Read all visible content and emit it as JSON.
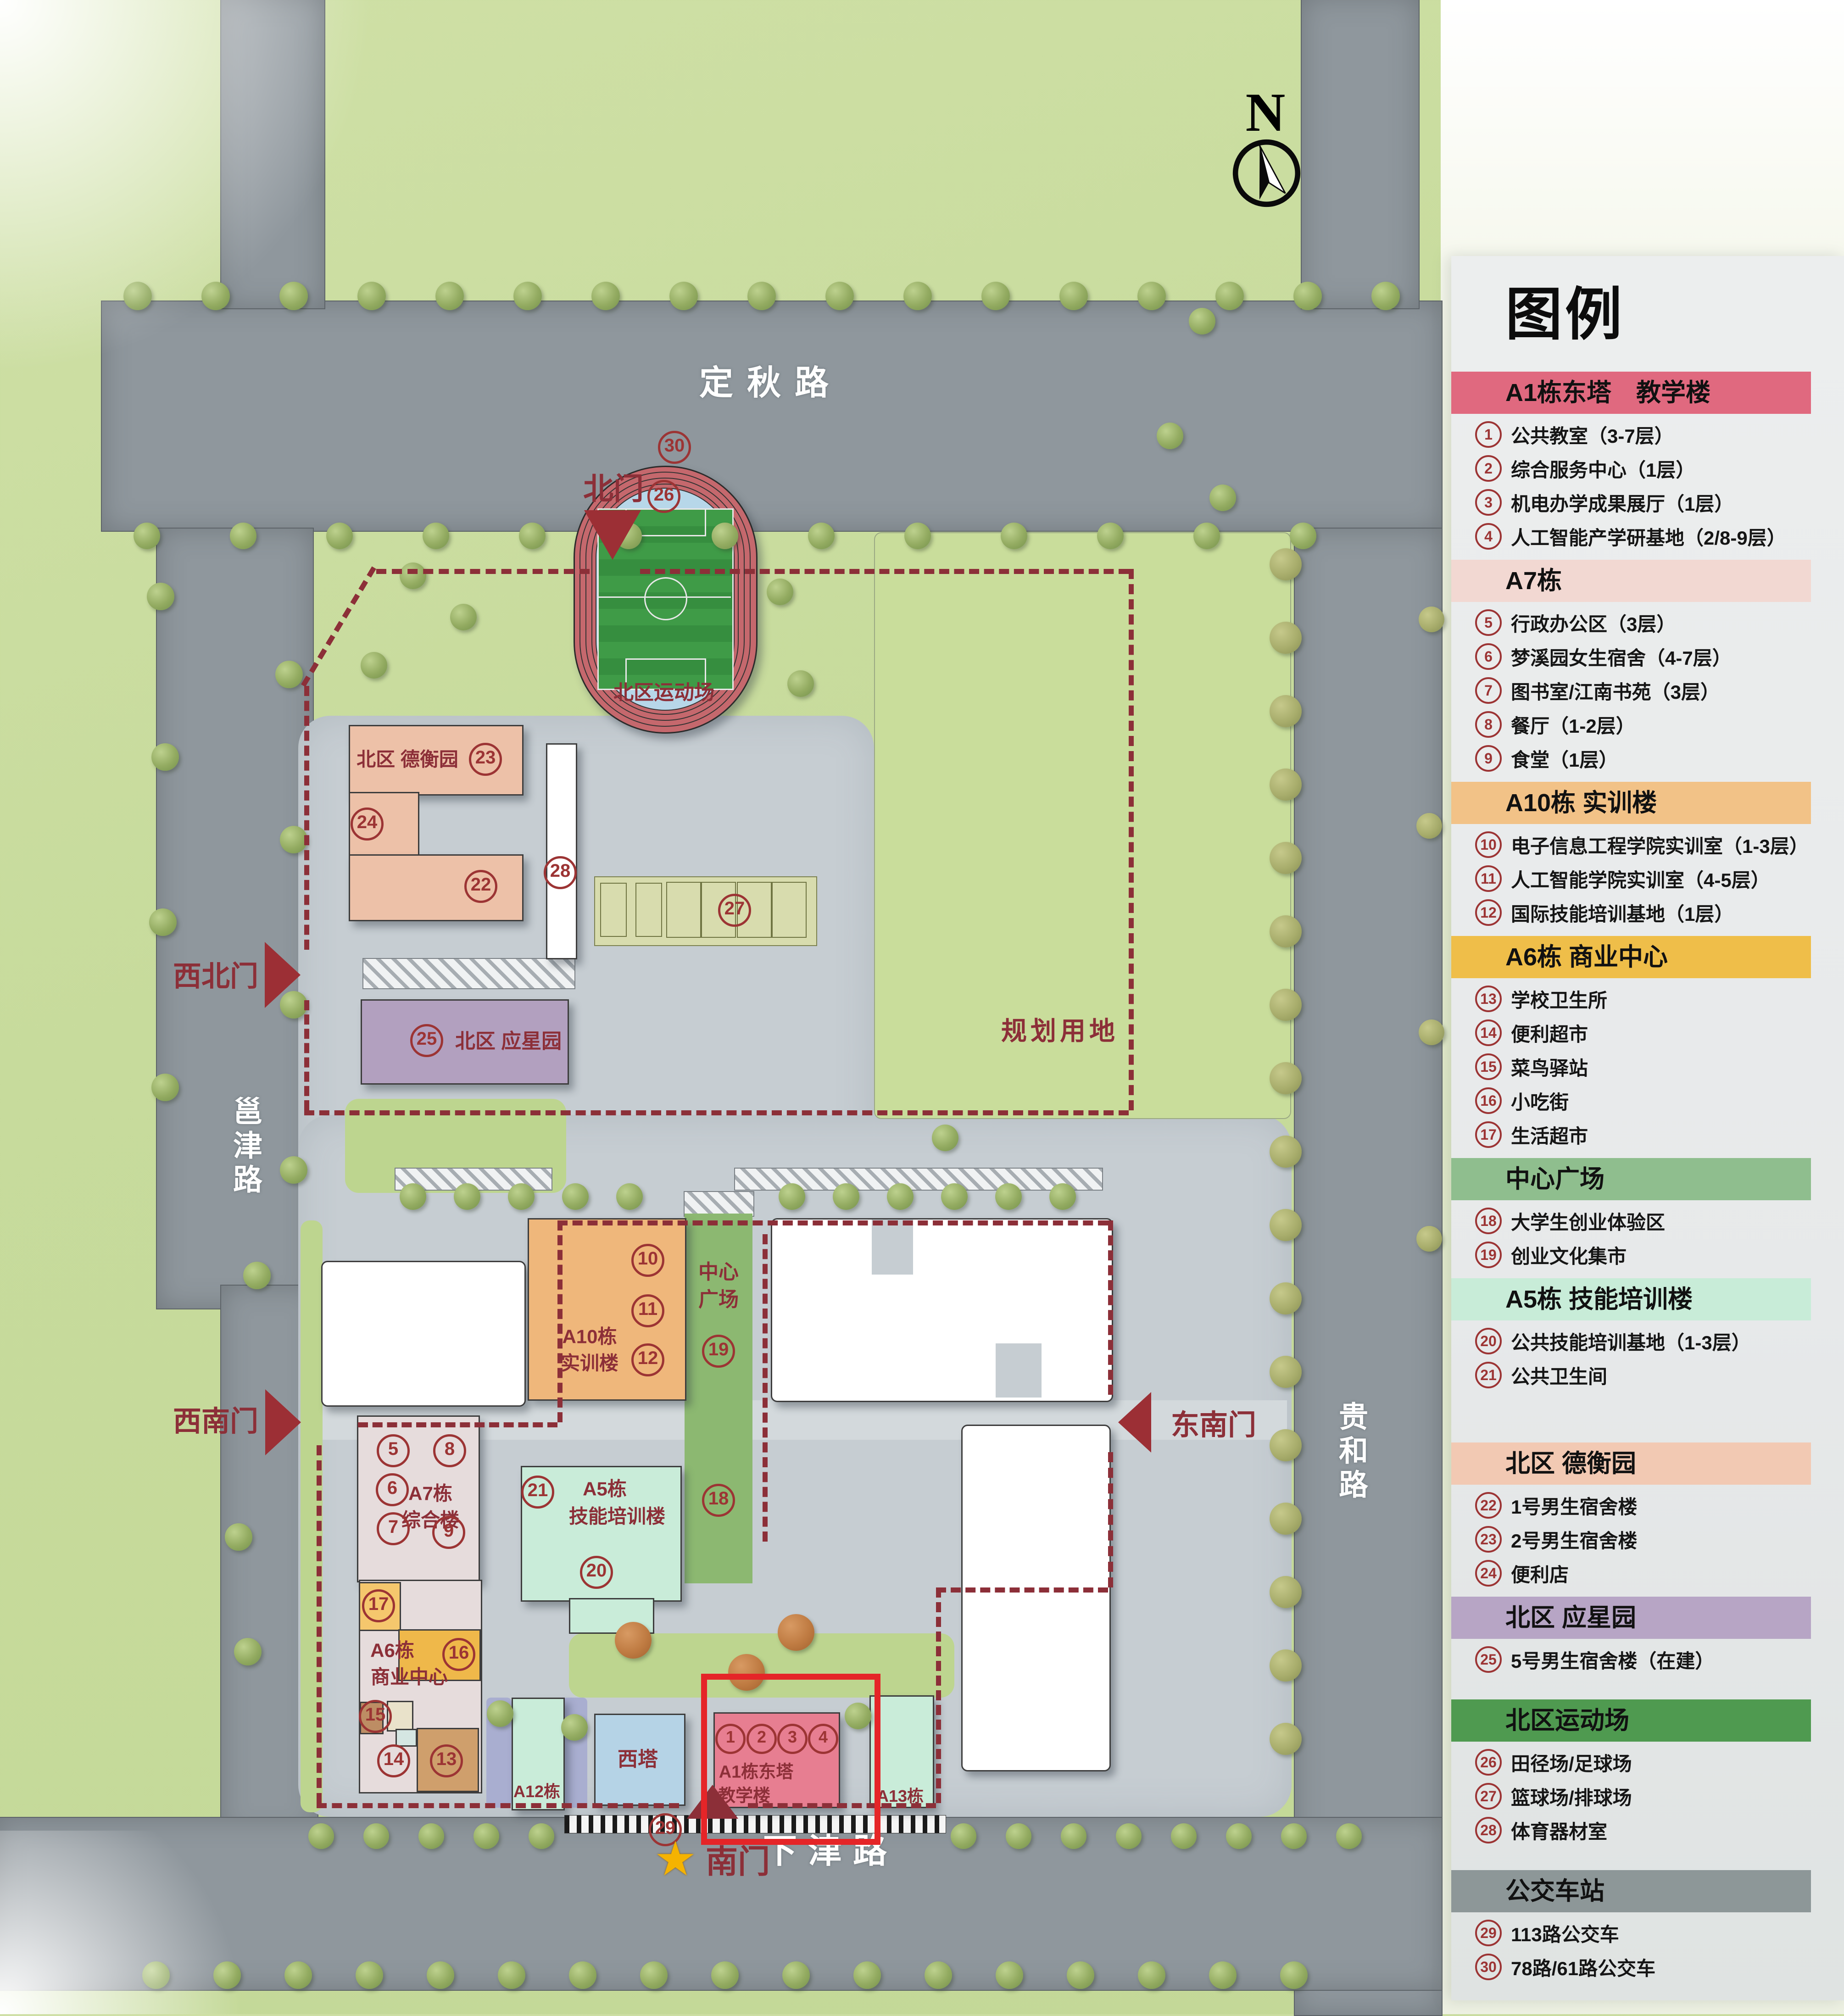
{
  "compass": {
    "north_label": "N"
  },
  "map": {
    "roads": {
      "top": "定秋路",
      "left": "邕津路",
      "right": "贵和路",
      "bottom": "下津路"
    },
    "gates": {
      "north": "北门",
      "northwest": "西北门",
      "southwest": "西南门",
      "southeast": "东南门",
      "south": "南门"
    },
    "areas": {
      "planning": "规划用地",
      "north_sports": "北区运动场",
      "dehengyuan": "北区 德衡园",
      "yingxingyuan": "北区 应星园",
      "plaza_line1": "中心",
      "plaza_line2": "广场"
    },
    "buildings": {
      "a10_line1": "A10栋",
      "a10_line2": "实训楼",
      "a5_line1": "A5栋",
      "a5_line2": "技能培训楼",
      "a7_line1": "A7栋",
      "a7_line2": "综合楼",
      "a6_line1": "A6栋",
      "a6_line2": "商业中心",
      "west_tower": "西塔",
      "a1_line1": "A1栋东塔",
      "a1_line2": "教学楼",
      "a12": "A12栋",
      "a13": "A13栋"
    },
    "markers": [
      "1",
      "2",
      "3",
      "4",
      "5",
      "6",
      "7",
      "8",
      "9",
      "10",
      "11",
      "12",
      "13",
      "14",
      "15",
      "16",
      "17",
      "18",
      "19",
      "20",
      "21",
      "22",
      "23",
      "24",
      "25",
      "26",
      "27",
      "28",
      "29",
      "30"
    ],
    "colors": {
      "boundary_dash": "#8c2f38",
      "marker_red": "#9c3434",
      "a1_pink": "#e77e91",
      "highlight_frame": "#e52528",
      "track_red": "#c5686d",
      "infield_blue": "#b7d7e9",
      "pitch_green": "#3f9b47",
      "dehengyuan_salmon": "#edc1a8",
      "yingxingyuan_purple": "#b2a0bf",
      "a10_orange": "#efb77b",
      "plaza_green": "#8cb871",
      "mint_green": "#c9ecd9",
      "west_tower_blue": "#b5d3e6",
      "star_gold": "#f5b301"
    },
    "south_gate_star": "★"
  },
  "legend": {
    "title": "图例",
    "sections": [
      {
        "header": "A1栋东塔　教学楼",
        "color": "#e0697f",
        "items": [
          {
            "num": "1",
            "text": "公共教室（3-7层）"
          },
          {
            "num": "2",
            "text": "综合服务中心（1层）"
          },
          {
            "num": "3",
            "text": "机电办学成果展厅（1层）"
          },
          {
            "num": "4",
            "text": "人工智能产学研基地（2/8-9层）"
          }
        ]
      },
      {
        "header": "A7栋",
        "color": "#f2d8d2",
        "items": [
          {
            "num": "5",
            "text": "行政办公区（3层）"
          },
          {
            "num": "6",
            "text": "梦溪园女生宿舍（4-7层）"
          },
          {
            "num": "7",
            "text": "图书室/江南书苑（3层）"
          },
          {
            "num": "8",
            "text": "餐厅（1-2层）"
          },
          {
            "num": "9",
            "text": "食堂（1层）"
          }
        ]
      },
      {
        "header": "A10栋  实训楼",
        "color": "#f2c287",
        "items": [
          {
            "num": "10",
            "text": "电子信息工程学院实训室（1-3层）"
          },
          {
            "num": "11",
            "text": "人工智能学院实训室（4-5层）"
          },
          {
            "num": "12",
            "text": "国际技能培训基地（1层）"
          }
        ]
      },
      {
        "header": "A6栋  商业中心",
        "color": "#efbe49",
        "items": [
          {
            "num": "13",
            "text": "学校卫生所"
          },
          {
            "num": "14",
            "text": "便利超市"
          },
          {
            "num": "15",
            "text": "菜鸟驿站"
          },
          {
            "num": "16",
            "text": "小吃街"
          },
          {
            "num": "17",
            "text": "生活超市"
          }
        ]
      },
      {
        "header": "中心广场",
        "color": "#8fbe8e",
        "items": [
          {
            "num": "18",
            "text": "大学生创业体验区"
          },
          {
            "num": "19",
            "text": "创业文化集市"
          }
        ]
      },
      {
        "header": "A5栋  技能培训楼",
        "color": "#c8ecd8",
        "items": [
          {
            "num": "20",
            "text": "公共技能培训基地（1-3层）"
          },
          {
            "num": "21",
            "text": "公共卫生间"
          }
        ]
      },
      {
        "header": "北区  德衡园",
        "color": "#f2c9b3",
        "items": [
          {
            "num": "22",
            "text": "1号男生宿舍楼"
          },
          {
            "num": "23",
            "text": "2号男生宿舍楼"
          },
          {
            "num": "24",
            "text": "便利店"
          }
        ]
      },
      {
        "header": "北区  应星园",
        "color": "#b7a5c5",
        "items": [
          {
            "num": "25",
            "text": "5号男生宿舍楼（在建）"
          }
        ]
      },
      {
        "header": "北区运动场",
        "color": "#4f9a50",
        "items": [
          {
            "num": "26",
            "text": "田径场/足球场"
          },
          {
            "num": "27",
            "text": "篮球场/排球场"
          },
          {
            "num": "28",
            "text": "体育器材室"
          }
        ]
      },
      {
        "header": "公交车站",
        "color": "#8d9798",
        "items": [
          {
            "num": "29",
            "text": "113路公交车"
          },
          {
            "num": "30",
            "text": "78路/61路公交车"
          }
        ]
      }
    ]
  }
}
